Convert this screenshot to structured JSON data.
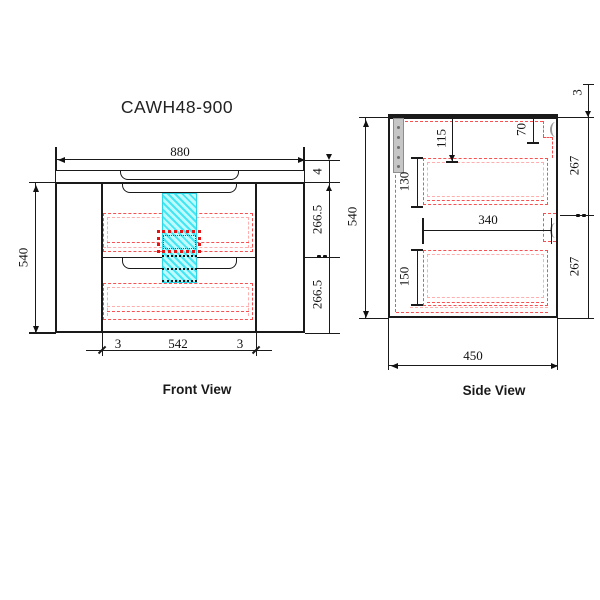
{
  "title": "CAWH48-900",
  "views": {
    "front": {
      "label": "Front View",
      "dims": {
        "width": "880",
        "top_thickness": "4",
        "upper_height": "266.5",
        "lower_height": "540",
        "lower_drawer_height": "266.5",
        "gap_left": "3",
        "inner_width": "542",
        "gap_right": "3",
        "height": "540"
      }
    },
    "side": {
      "label": "Side View",
      "dims": {
        "top_thickness": "3",
        "height": "540",
        "d115": "115",
        "d130": "130",
        "d70": "70",
        "upper_267": "267",
        "d340": "340",
        "d150": "150",
        "lower_267": "267",
        "depth": "450"
      }
    }
  },
  "colors": {
    "line": "#1a1a1a",
    "hidden_red": "#f85050",
    "hidden_red_light": "#ffadad",
    "dotted_red": "#e51414",
    "highlight_cyan": "#43e6f2",
    "bracket_gray": "#c6c6c6"
  }
}
